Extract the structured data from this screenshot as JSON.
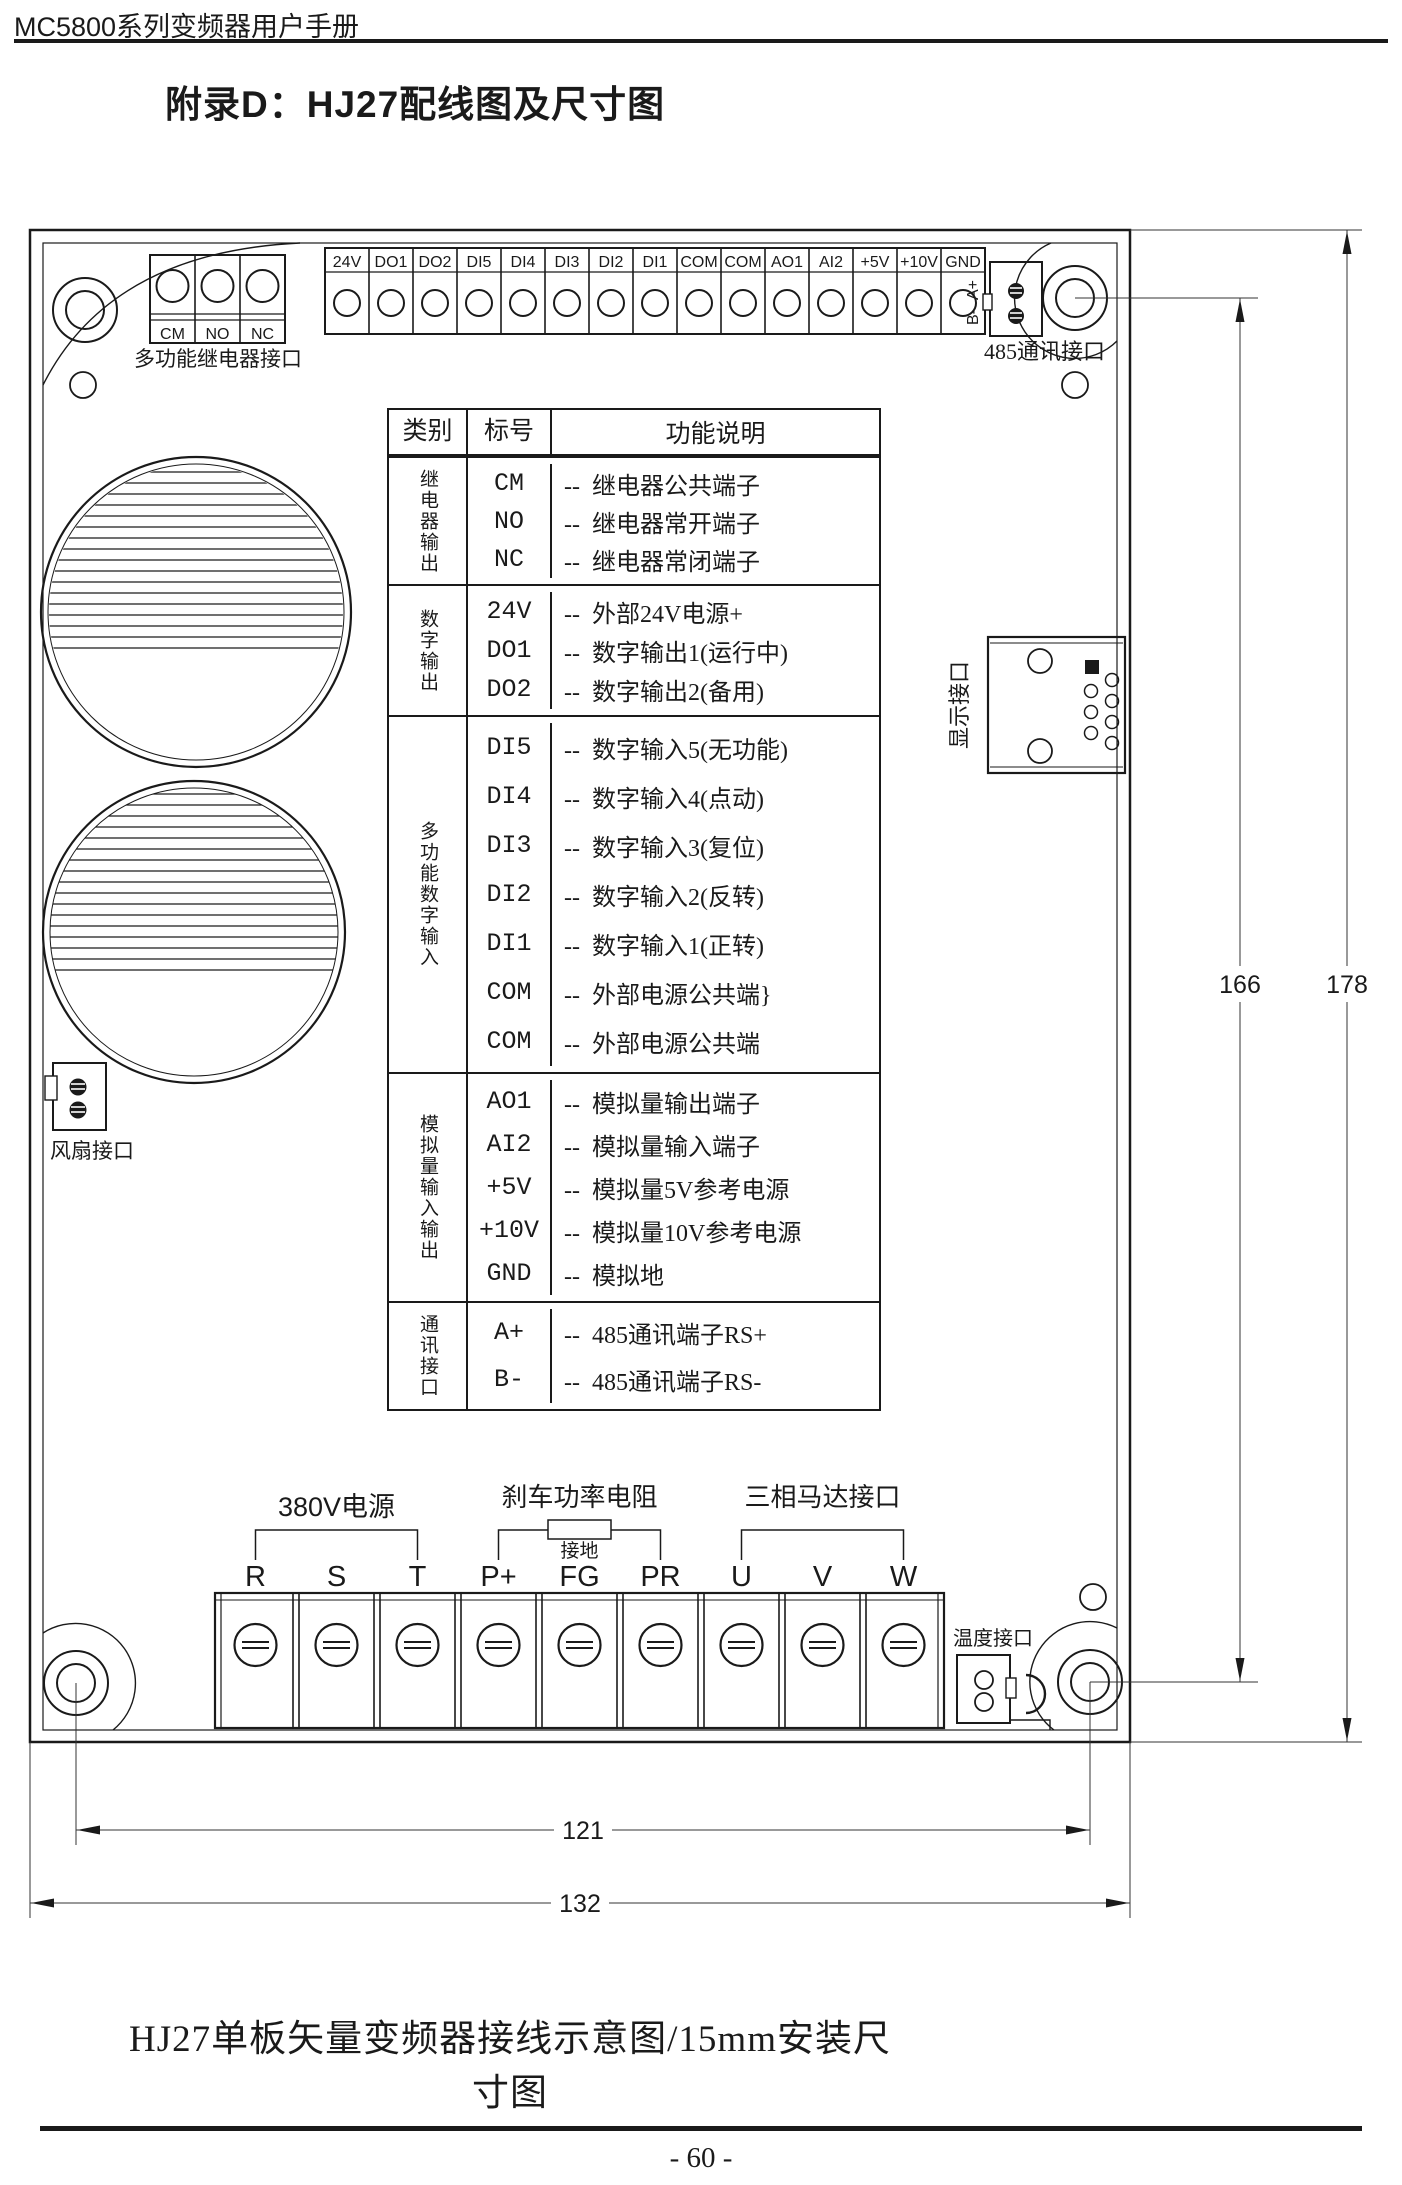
{
  "page": {
    "header": "MC5800系列变频器用户手册",
    "title": "附录D：HJ27配线图及尺寸图",
    "caption": "HJ27单板矢量变频器接线示意图/15mm安装尺寸图",
    "page_number": "- 60 -"
  },
  "board": {
    "relay_connector": {
      "labels": [
        "CM",
        "NO",
        "NC"
      ],
      "caption": "多功能继电器接口"
    },
    "top_terminals": [
      "24V",
      "DO1",
      "DO2",
      "DI5",
      "DI4",
      "DI3",
      "DI2",
      "DI1",
      "COM",
      "COM",
      "AO1",
      "AI2",
      "+5V",
      "+10V",
      "GND"
    ],
    "comm_port": {
      "pin_top": "A+",
      "pin_bottom": "B-",
      "caption": "485通讯接口"
    },
    "display_port": {
      "caption": "显示接口"
    },
    "fan_port": {
      "caption": "风扇接口"
    },
    "temp_port": {
      "caption": "温度接口"
    },
    "bottom_terminals": [
      "R",
      "S",
      "T",
      "P+",
      "FG",
      "PR",
      "U",
      "V",
      "W"
    ],
    "bottom_groups": {
      "power": "380V电源",
      "brake": "刹车功率电阻",
      "ground": "接地",
      "motor": "三相马达接口"
    },
    "dimensions": {
      "height_inner": "166",
      "height_outer": "178",
      "width_inner": "121",
      "width_outer": "132"
    }
  },
  "table": {
    "headers": [
      "类别",
      "标号",
      "功能说明"
    ],
    "groups": [
      {
        "category": "继电器输出",
        "rows": [
          [
            "CM",
            "--  继电器公共端子"
          ],
          [
            "NO",
            "--  继电器常开端子"
          ],
          [
            "NC",
            "--  继电器常闭端子"
          ]
        ]
      },
      {
        "category": "数字输出",
        "rows": [
          [
            "24V",
            "--  外部24V电源+"
          ],
          [
            "DO1",
            "--  数字输出1(运行中)"
          ],
          [
            "DO2",
            "--  数字输出2(备用)"
          ]
        ]
      },
      {
        "category": "多功能数字输入",
        "rows": [
          [
            "DI5",
            "--  数字输入5(无功能)"
          ],
          [
            "DI4",
            "--  数字输入4(点动)"
          ],
          [
            "DI3",
            "--  数字输入3(复位)"
          ],
          [
            "DI2",
            "--  数字输入2(反转)"
          ],
          [
            "DI1",
            "--  数字输入1(正转)"
          ],
          [
            "COM",
            "--  外部电源公共端}"
          ],
          [
            "COM",
            "--  外部电源公共端"
          ]
        ]
      },
      {
        "category": "模拟量输入输出",
        "rows": [
          [
            "AO1",
            "--  模拟量输出端子"
          ],
          [
            "AI2",
            "--  模拟量输入端子"
          ],
          [
            "+5V",
            "--  模拟量5V参考电源"
          ],
          [
            "+10V",
            "--  模拟量10V参考电源"
          ],
          [
            "GND",
            "--  模拟地"
          ]
        ]
      },
      {
        "category": "通讯接口",
        "rows": [
          [
            "A+",
            "--  485通讯端子RS+"
          ],
          [
            "B-",
            "--  485通讯端子RS-"
          ]
        ]
      }
    ]
  }
}
